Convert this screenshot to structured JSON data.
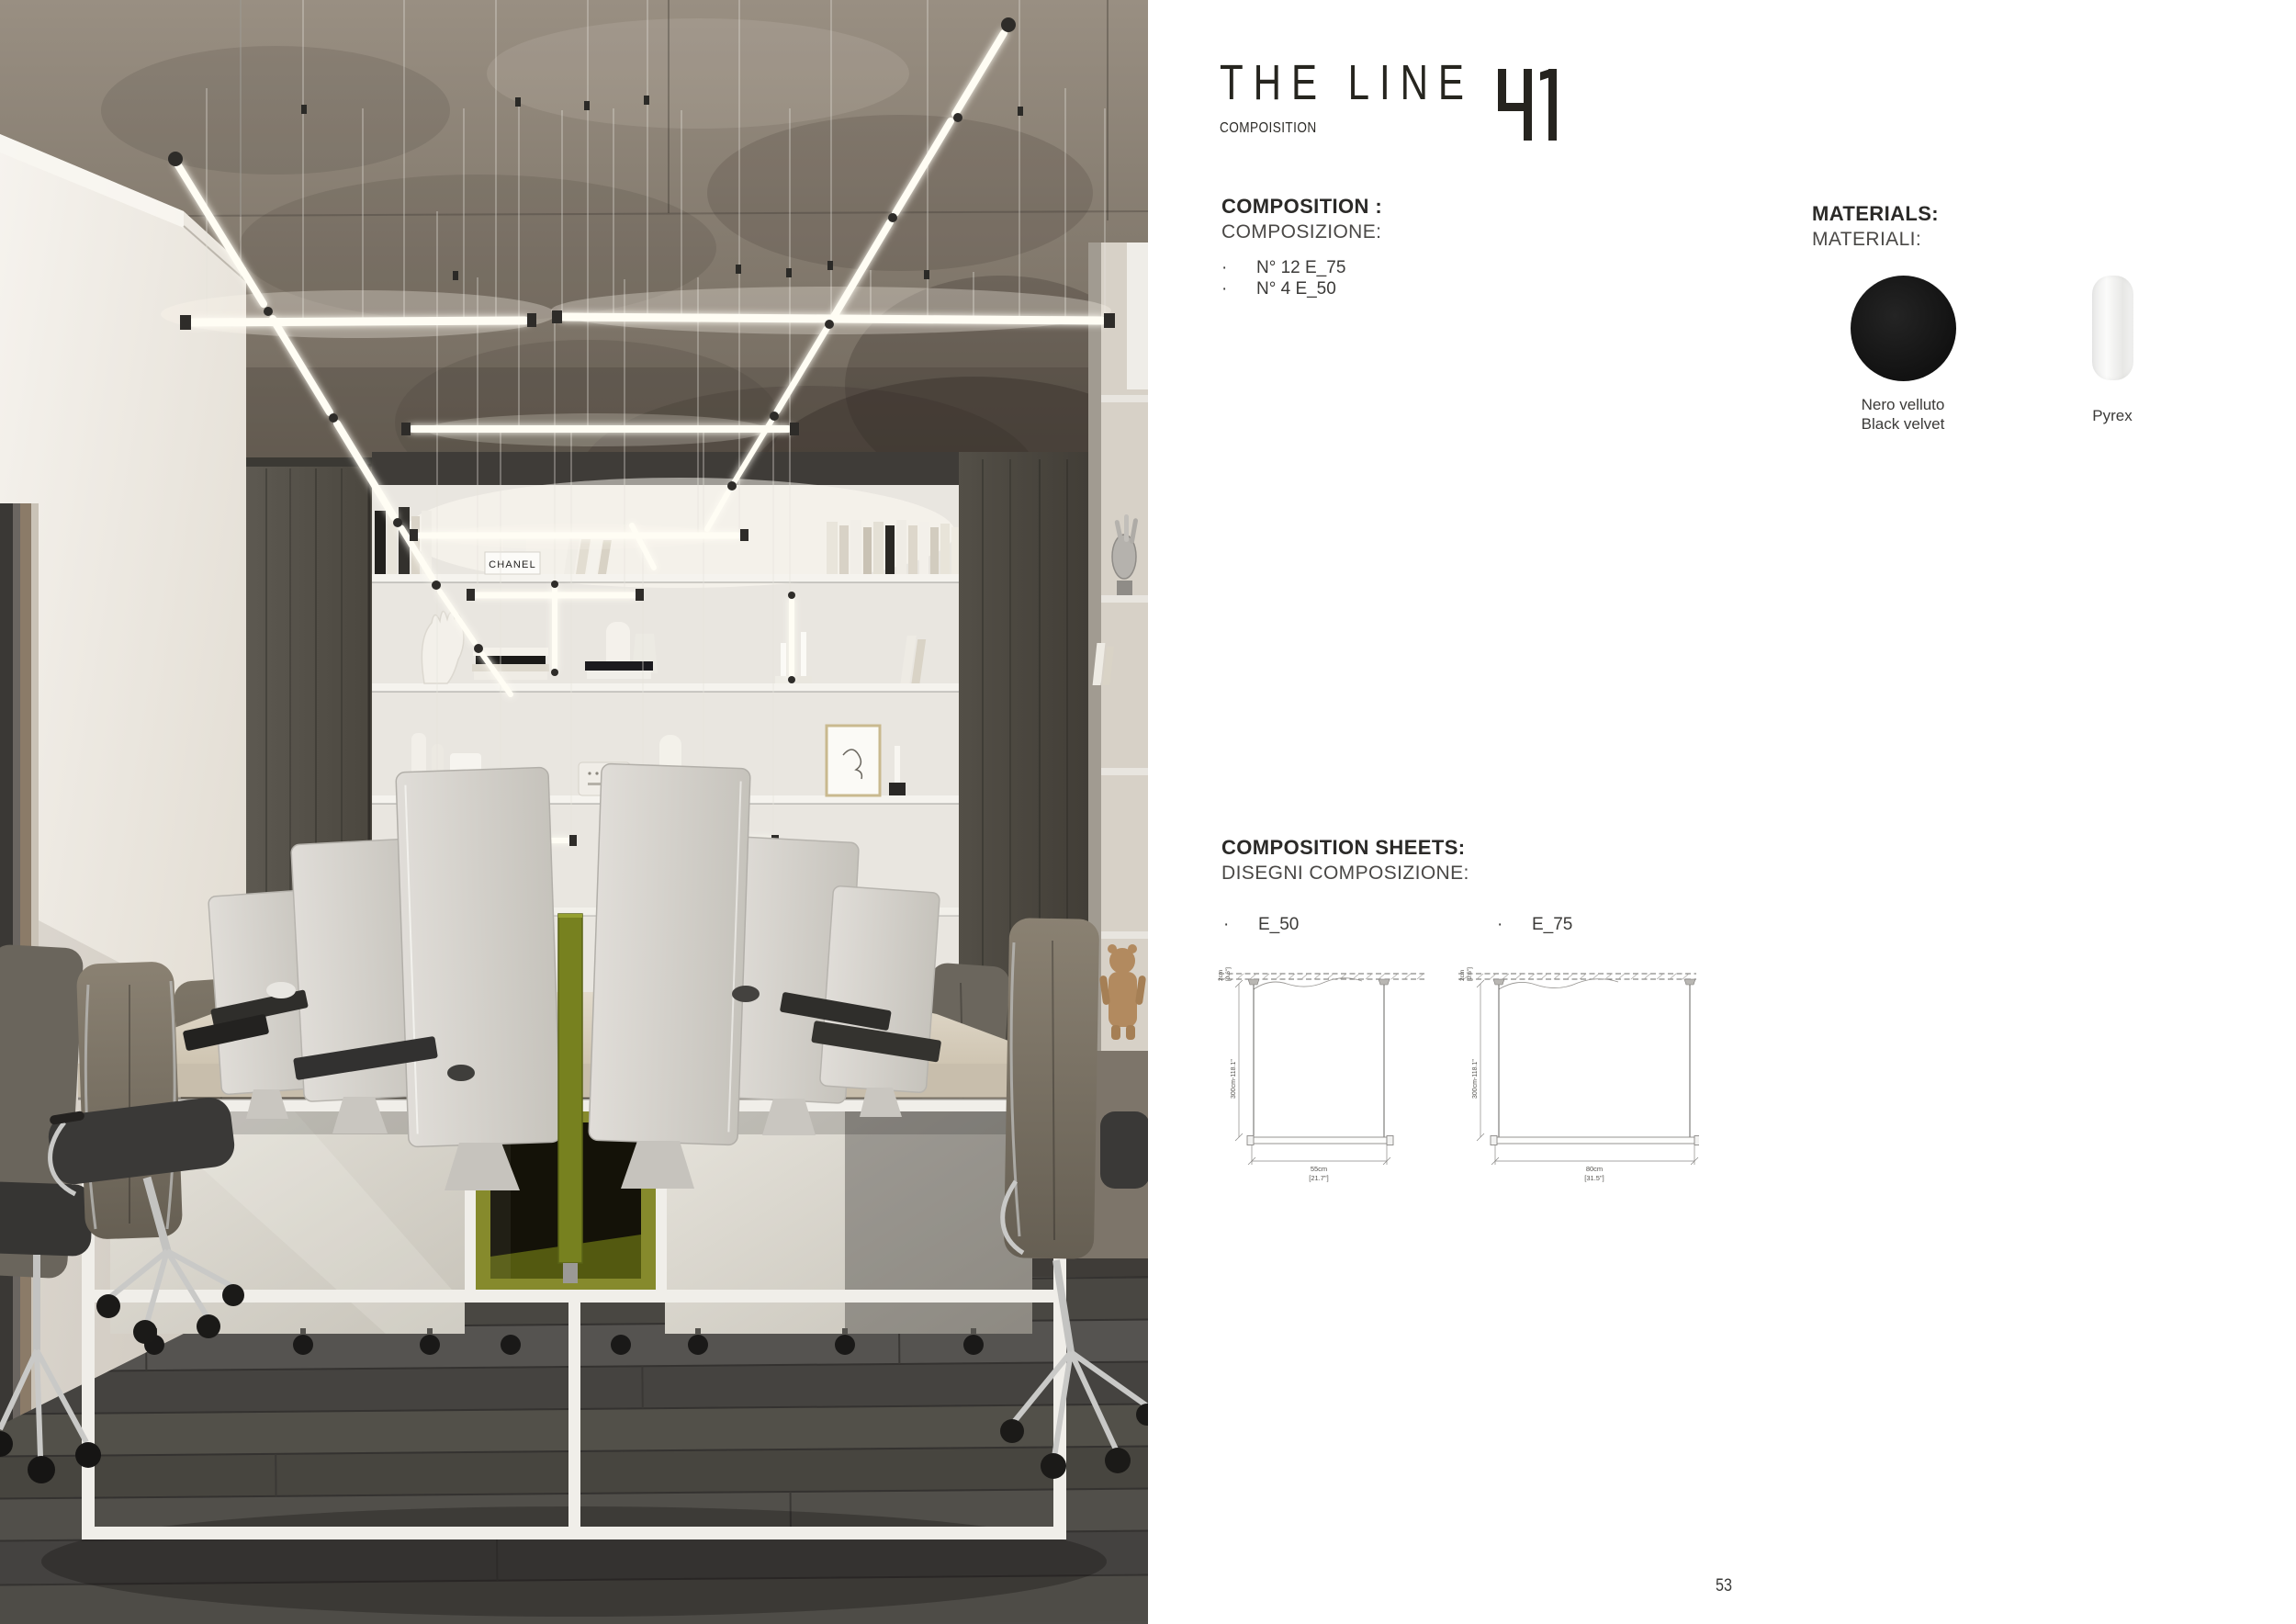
{
  "brand": {
    "title": "THE LINE",
    "number": "41",
    "subtitle": "COMPOISITION"
  },
  "composition": {
    "heading_en": "COMPOSITION :",
    "heading_it": "COMPOSIZIONE:",
    "items": [
      "N° 12 E_75",
      "N° 4 E_50"
    ]
  },
  "materials": {
    "heading_en": "MATERIALS:",
    "heading_it": "MATERIALI:",
    "swatches": [
      {
        "label_line1": "Nero velluto",
        "label_line2": "Black velvet",
        "color": "#141414",
        "shape": "circle"
      },
      {
        "label_line1": "Pyrex",
        "label_line2": "",
        "color": "#f1f1f0",
        "shape": "cylinder"
      }
    ]
  },
  "sheets": {
    "heading_en": "COMPOSITION SHEETS:",
    "heading_it": "DISEGNI COMPOSIZIONE:",
    "drawings": [
      {
        "item": "E_50",
        "width_cm": "55cm",
        "width_in": "[21.7\"]",
        "drop": "300cm-118.1\"",
        "ceiling_gap": "2cm",
        "ceiling_gap_in": "[0.6\"]"
      },
      {
        "item": "E_75",
        "width_cm": "80cm",
        "width_in": "[31.5\"]",
        "drop": "300cm-118.1\"",
        "ceiling_gap": "2cm",
        "ceiling_gap_in": "[0.6\"]"
      }
    ]
  },
  "photo": {
    "book_label": "CHANEL"
  },
  "page_number": "53",
  "accent_colors": {
    "olive_cube": "#868a2c",
    "desk_top": "#d9d0c0",
    "light_tube": "#fffdf4"
  }
}
